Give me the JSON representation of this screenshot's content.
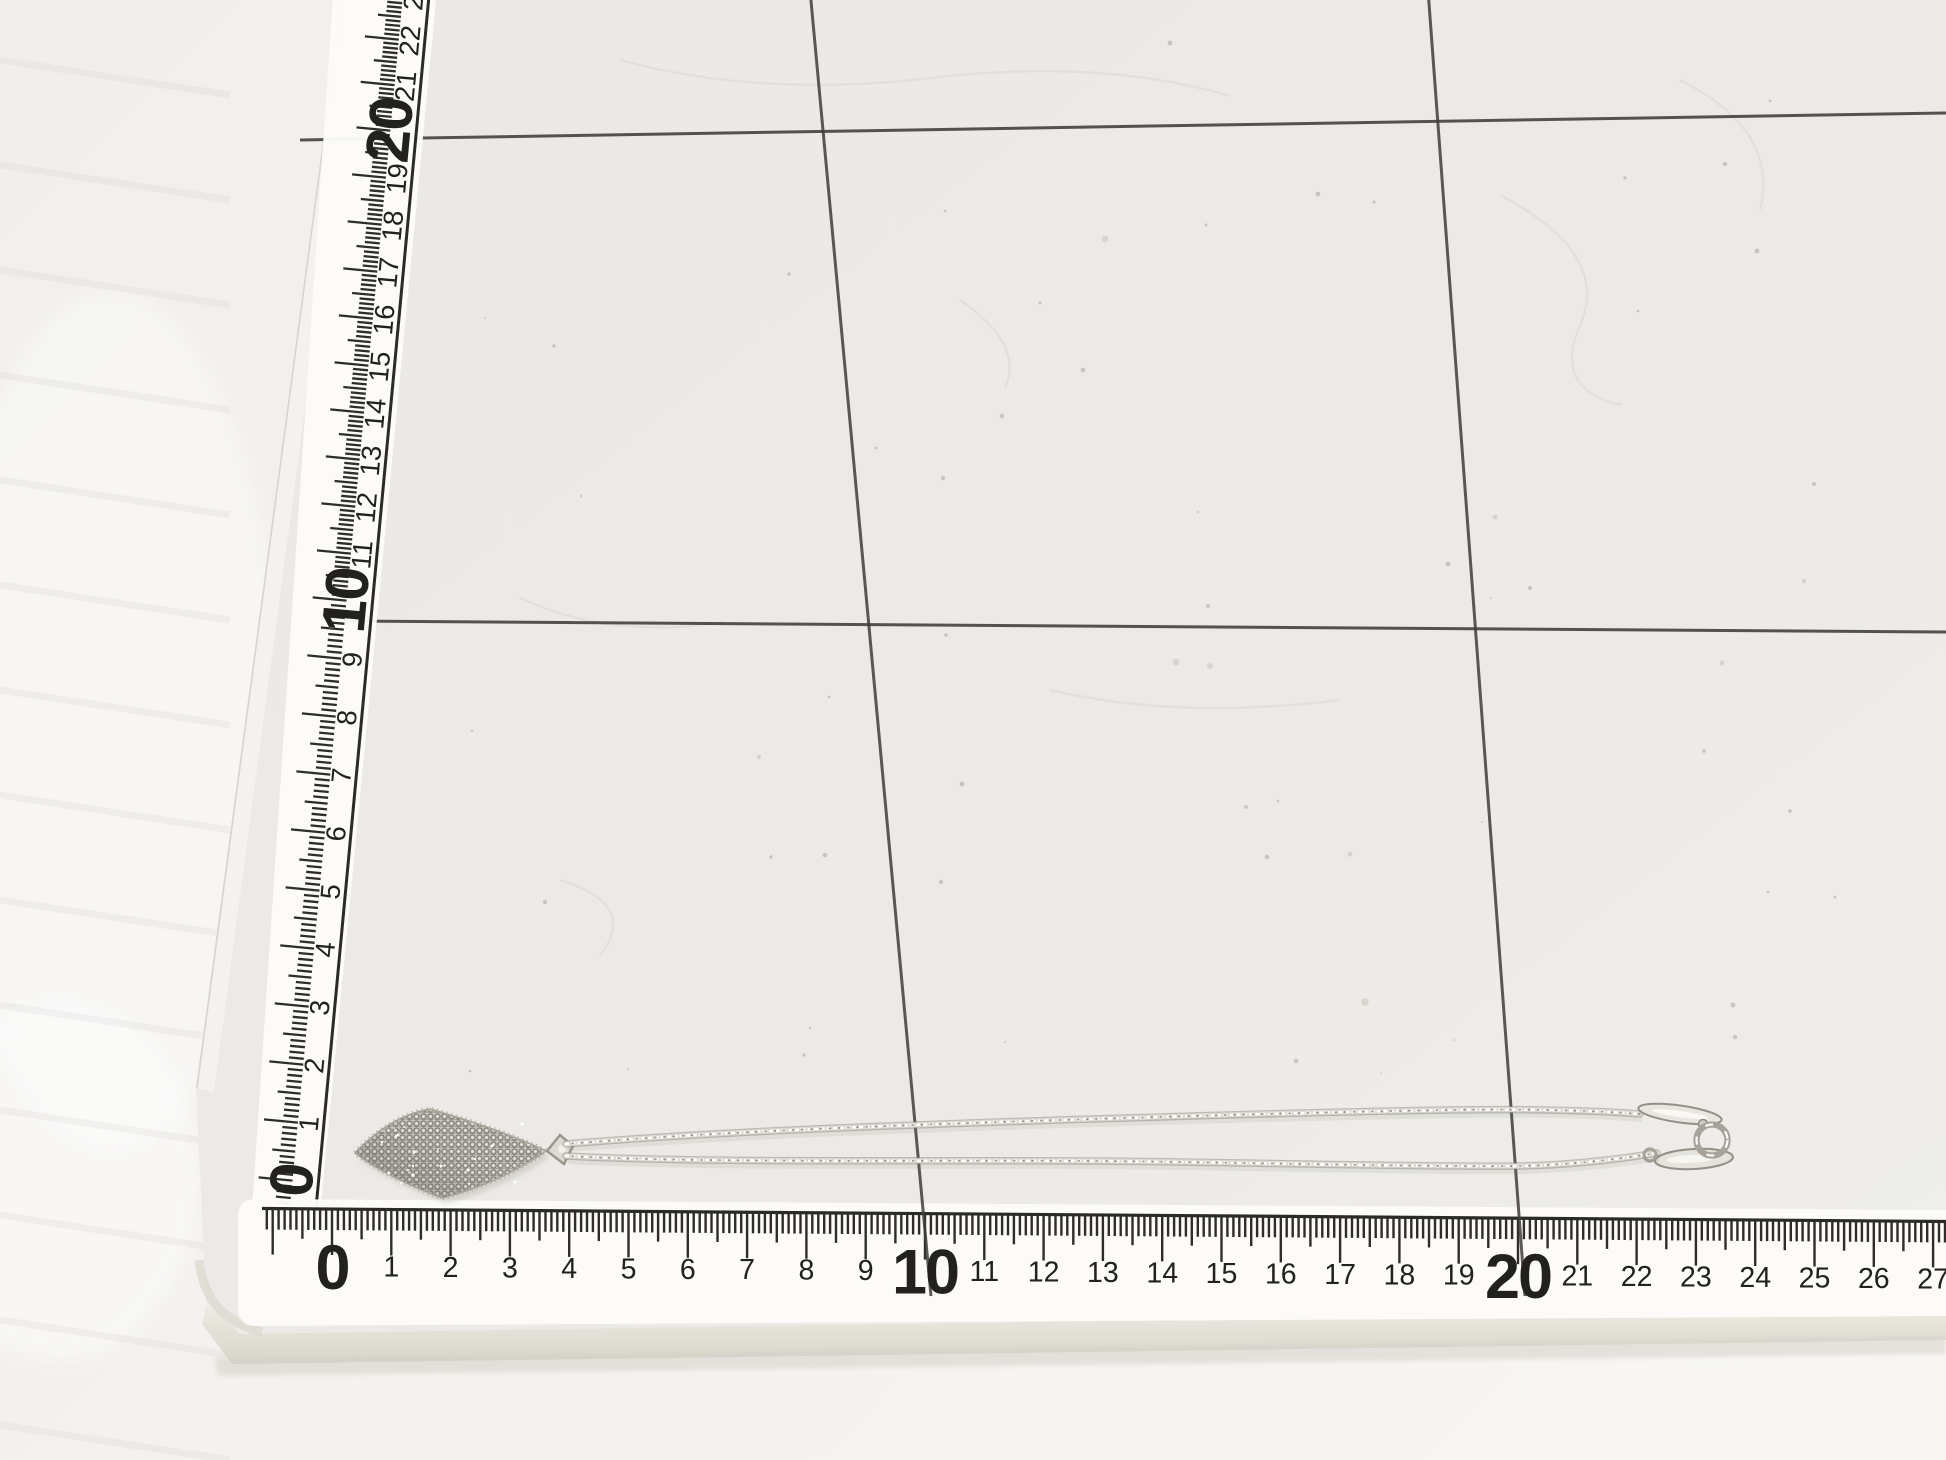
{
  "scene": {
    "type": "photograph",
    "subject": "silver mesh kite-shaped pendant necklace with double chain strands and spring-ring clasp, measured on a gridded cutting mat"
  },
  "left_ruler": {
    "orientation": "vertical",
    "numbers": [
      "0",
      "1",
      "2",
      "3",
      "4",
      "5",
      "6",
      "7",
      "8",
      "9",
      "10",
      "11",
      "12",
      "13",
      "14",
      "15",
      "16",
      "17",
      "18",
      "19",
      "20",
      "21",
      "22",
      "23"
    ],
    "bold_numbers": [
      "0",
      "10",
      "20"
    ]
  },
  "bottom_ruler": {
    "orientation": "horizontal",
    "numbers": [
      "0",
      "1",
      "2",
      "3",
      "4",
      "5",
      "6",
      "7",
      "8",
      "9",
      "10",
      "11",
      "12",
      "13",
      "14",
      "15",
      "16",
      "17",
      "18",
      "19",
      "20",
      "21",
      "22",
      "23",
      "24",
      "25",
      "26",
      "27"
    ],
    "bold_numbers": [
      "0",
      "10",
      "20"
    ]
  },
  "grid": {
    "horizontal_lines": 2,
    "vertical_lines": 2
  },
  "colors": {
    "mat": "#eceae6",
    "grid_line": "#403e3a",
    "ruler_body": "#fcfbf8",
    "ruler_marks": "#2e2d2a",
    "digits": "#222120",
    "fabric": "#f3f1ee",
    "mat_edge_band": "#e4e1d8",
    "silver_mid": "#cac6bf",
    "silver_dark": "#87837b",
    "silver_light": "#f4f2ed"
  }
}
